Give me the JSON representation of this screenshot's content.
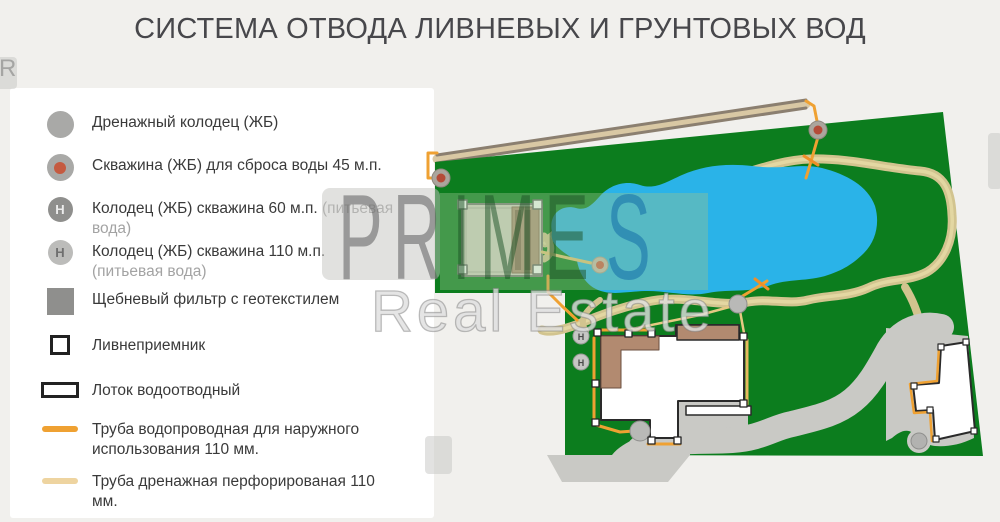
{
  "title": "СИСТЕМА ОТВОДА ЛИВНЕВЫХ И ГРУНТОВЫХ ВОД",
  "watermark": {
    "letters_gray": "PR",
    "letters_green": "IME",
    "letters_blue": "S",
    "line2": "Real Estate",
    "tile_letter": "R"
  },
  "colors": {
    "plot_green": "#0c7d1e",
    "pond_blue": "#2ab3e8",
    "path_tan": "#d2c48f",
    "driveway_gray": "#c9c9c5",
    "roof_brown": "#b28a70",
    "water_pipe_orange": "#efa132",
    "drain_pipe_light": "#eed4a0",
    "well_gray": "#a9a9a7",
    "borehole_red": "#c55a40"
  },
  "legend": {
    "items": [
      {
        "id": "drain-well",
        "icon": "circle",
        "color": "#a9a9a7",
        "label": "Дренажный колодец (ЖБ)",
        "muted": ""
      },
      {
        "id": "discharge-well",
        "icon": "circle-dot",
        "color": "#a9a9a7",
        "dot": "#c55a40",
        "label": "Скважина (ЖБ) для сброса воды 45 м.п.",
        "muted": ""
      },
      {
        "id": "well-60",
        "icon": "circle-letter",
        "color": "#8f8f8d",
        "letter": "Н",
        "letter_color": "#ececec",
        "label": "Колодец (ЖБ) скважина 60 м.п.",
        "muted": "(питьевая вода)"
      },
      {
        "id": "well-110",
        "icon": "circle-letter",
        "color": "#bcbcba",
        "letter": "Н",
        "letter_color": "#6f6f6f",
        "label": "Колодец (ЖБ) скважина 110 м.п.",
        "muted": "(питьевая вода)"
      },
      {
        "id": "gravel-filter",
        "icon": "square",
        "color": "#8f8f8d",
        "label": "Щебневый фильтр с геотекстилем",
        "muted": ""
      },
      {
        "id": "storm-inlet",
        "icon": "square-outline",
        "label": "Ливнеприемник",
        "muted": ""
      },
      {
        "id": "drain-tray",
        "icon": "rect-outline",
        "label": "Лоток водоотводный",
        "muted": ""
      },
      {
        "id": "water-pipe",
        "icon": "line",
        "color": "#efa132",
        "label": "Труба водопроводная для наружного использования 110 мм.",
        "muted": ""
      },
      {
        "id": "drain-pipe",
        "icon": "line",
        "color": "#eed4a0",
        "label": "Труба дренажная перфорированая 110 мм.",
        "muted": ""
      }
    ]
  },
  "map": {
    "shapes": [
      {
        "n": "channel-fill",
        "t": "line",
        "x1": 437,
        "y1": 159,
        "x2": 806,
        "y2": 104,
        "s": "#d9c8a4",
        "w": 9
      },
      {
        "n": "channel-edge-top",
        "t": "line",
        "x1": 437,
        "y1": 155,
        "x2": 806,
        "y2": 100,
        "s": "#8b7f70",
        "w": 3
      },
      {
        "n": "channel-edge-bottom",
        "t": "line",
        "x1": 437,
        "y1": 163,
        "x2": 806,
        "y2": 108,
        "s": "#8b7f70",
        "w": 3
      },
      {
        "n": "pipe-channel-left",
        "t": "pline",
        "pts": [
          [
            437,
            153
          ],
          [
            428,
            153
          ],
          [
            428,
            178
          ],
          [
            441,
            178
          ]
        ],
        "s": "#efa132",
        "w": 3
      },
      {
        "n": "pipe-channel-right",
        "t": "pline",
        "pts": [
          [
            806,
            101
          ],
          [
            814,
            106
          ],
          [
            817,
            121
          ]
        ],
        "s": "#efa132",
        "w": 3
      },
      {
        "n": "plot",
        "t": "poly",
        "pts": [
          [
            435,
            162
          ],
          [
            943,
            112
          ],
          [
            983,
            456
          ],
          [
            565,
            455
          ],
          [
            565,
            293
          ],
          [
            435,
            293
          ]
        ],
        "f": "#0c7d1e"
      },
      {
        "n": "path-loop",
        "t": "path",
        "d": "M545,243 C570,218 620,200 680,190 C730,182 770,160 810,159 C850,158 885,168 920,171 C945,173 951,192 952,215 C954,240 944,262 927,272 C908,282 888,278 868,288 C848,297 828,295 808,300 C788,305 768,298 748,302 C718,307 688,296 658,300 C628,304 598,316 576,325 C562,330 550,333 542,330",
        "s": "#d2c48f",
        "w": 9
      },
      {
        "n": "path-loop-inner",
        "t": "path",
        "d": "M545,243 C570,218 620,200 680,190 C730,182 770,160 810,159 C850,158 885,168 920,171 C945,173 951,192 952,215 C954,240 944,262 927,272 C908,282 888,278 868,288 C848,297 828,295 808,300 C788,305 768,298 748,302 C718,307 688,296 658,300 C628,304 598,316 576,325 C562,330 550,333 542,330",
        "s": "#e3d7a2",
        "w": 3.5
      },
      {
        "n": "path-branch-right",
        "t": "path",
        "d": "M905,287 C913,300 918,312 921,328",
        "s": "#d2c48f",
        "w": 8
      },
      {
        "n": "path-branch-house",
        "t": "path",
        "d": "M600,300 C586,310 578,320 586,331",
        "s": "#d2c48f",
        "w": 6
      },
      {
        "n": "path-hook-garage",
        "t": "path",
        "d": "M544,236 C553,243 553,255 544,259",
        "s": "#d2c48f",
        "w": 7
      },
      {
        "n": "pond",
        "t": "path",
        "d": "M552,232 C548,214 562,204 576,208 C586,211 592,205 600,196 C610,185 625,180 640,185 C655,190 666,182 682,175 C702,166 726,163 752,166 C782,170 802,163 822,168 C846,174 868,186 875,206 C880,223 876,241 864,253 C853,264 843,270 828,275 C808,282 788,278 768,286 C748,293 728,289 708,293 C688,297 668,291 648,291 C628,291 613,296 598,290 C584,284 579,271 577,261 C569,256 559,250 554,243 C552,240 551,236 552,232 Z",
        "f": "#2ab3e8"
      },
      {
        "n": "pipe-well-to-pond",
        "t": "pline",
        "pts": [
          [
            818,
            137
          ],
          [
            812,
            158
          ],
          [
            806,
            178
          ]
        ],
        "s": "#efa132",
        "w": 3
      },
      {
        "n": "pipe-cross-mark",
        "t": "line",
        "x1": 804,
        "y1": 156,
        "x2": 818,
        "y2": 165,
        "s": "#ef8f28",
        "w": 3
      },
      {
        "n": "borehole-well-left",
        "t": "circle",
        "cx": 441,
        "cy": 178,
        "r": 9,
        "f": "#aba59d",
        "s": "#8f887f",
        "sw": 1
      },
      {
        "n": "borehole-well-left-center",
        "t": "circle",
        "cx": 441,
        "cy": 178,
        "r": 4.5,
        "f": "#b44b38"
      },
      {
        "n": "borehole-well-top",
        "t": "circle",
        "cx": 818,
        "cy": 130,
        "r": 9,
        "f": "#aba59d",
        "s": "#8f887f",
        "sw": 1
      },
      {
        "n": "borehole-well-top-center",
        "t": "circle",
        "cx": 818,
        "cy": 130,
        "r": 4.5,
        "f": "#b44b38"
      },
      {
        "n": "garage",
        "t": "rect",
        "x": 462,
        "y": 204,
        "w": 80,
        "h": 72,
        "f": "#d8d2c6",
        "s": "#7c7c78",
        "sw": 2
      },
      {
        "n": "garage-inner-border",
        "t": "rect",
        "x": 466,
        "y": 208,
        "w": 72,
        "h": 64,
        "s": "#b3afa5",
        "sw": 1
      },
      {
        "n": "garage-deck",
        "t": "rect",
        "x": 512,
        "y": 207,
        "w": 27,
        "h": 66,
        "f": "#b18f79",
        "s": "#8a6c58",
        "sw": 1
      },
      {
        "n": "garage-deck-stripe",
        "t": "rect",
        "x": 515,
        "y": 210,
        "w": 6,
        "h": 60,
        "f": "#8a6c58"
      },
      {
        "n": "garage-deck-stripe",
        "t": "rect",
        "x": 525,
        "y": 210,
        "w": 6,
        "h": 60,
        "f": "#8a6c58"
      },
      {
        "n": "garage-corner-inlet",
        "t": "rect",
        "x": 458,
        "y": 200,
        "w": 9,
        "h": 9,
        "f": "#ffffff",
        "s": "#666666",
        "sw": 1.5
      },
      {
        "n": "garage-corner-inlet",
        "t": "rect",
        "x": 533,
        "y": 200,
        "w": 9,
        "h": 9,
        "f": "#ffffff",
        "s": "#666666",
        "sw": 1.5
      },
      {
        "n": "garage-corner-inlet",
        "t": "rect",
        "x": 458,
        "y": 265,
        "w": 9,
        "h": 9,
        "f": "#ffffff",
        "s": "#666666",
        "sw": 1.5
      },
      {
        "n": "garage-corner-inlet",
        "t": "rect",
        "x": 533,
        "y": 265,
        "w": 9,
        "h": 9,
        "f": "#ffffff",
        "s": "#666666",
        "sw": 1.5
      },
      {
        "n": "pipe-garage-to-well",
        "t": "pline",
        "pts": [
          [
            542,
            252
          ],
          [
            568,
            258
          ],
          [
            591,
            263
          ]
        ],
        "s": "#e7c477",
        "w": 3
      },
      {
        "n": "pipe-garage-down",
        "t": "pline",
        "pts": [
          [
            548,
            276
          ],
          [
            548,
            292
          ],
          [
            562,
            306
          ],
          [
            577,
            320
          ]
        ],
        "s": "#efa132",
        "w": 3
      },
      {
        "n": "borehole-well-pond",
        "t": "circle",
        "cx": 600,
        "cy": 265,
        "r": 8,
        "f": "#cbb9ae",
        "s": "#b09e92",
        "sw": 1
      },
      {
        "n": "borehole-well-pond-center",
        "t": "circle",
        "cx": 600,
        "cy": 265,
        "r": 4,
        "f": "#d05a44"
      },
      {
        "n": "driveway-patio",
        "t": "path",
        "d": "M678,401 L748,401 L748,438 L678,438 Z",
        "f": "#c9c9c5"
      },
      {
        "n": "driveway-road",
        "t": "path",
        "d": "M640,449 C680,438 702,442 732,440 C762,438 772,428 792,424 C816,418 836,414 853,400 C869,387 879,368 889,350 C895,340 903,333 913,329 C923,325 933,325 941,327",
        "s": "#c9c9c5",
        "w": 26
      },
      {
        "n": "driveway-right-blob",
        "t": "path",
        "d": "M886,328 L968,336 L974,438 C960,445 946,447 935,446 C925,445 920,438 913,433 C906,428 899,432 892,438 L886,441 Z",
        "f": "#c9c9c5"
      },
      {
        "n": "driveway-entrance",
        "t": "path",
        "d": "M547,455 L612,455 C618,447 628,442 638,437 C652,430 672,428 690,432 L690,455 L668,482 L562,482 Z",
        "f": "#c9c9c5"
      },
      {
        "n": "driveway-bump",
        "t": "circle",
        "cx": 919,
        "cy": 441,
        "r": 12,
        "f": "#c9c9c5"
      },
      {
        "n": "drain-tray",
        "t": "rect",
        "x": 686,
        "y": 406,
        "w": 65,
        "h": 9,
        "f": "#ffffff",
        "s": "#2a2a2a",
        "sw": 1.5
      },
      {
        "n": "main-house",
        "t": "path",
        "d": "M601,336 L676,336 L676,325 L739,325 L739,336 L744,336 L744,401 L678,401 L678,438 L650,438 L650,420 L601,420 Z",
        "f": "#ffffff",
        "s": "#2a2a2a",
        "sw": 2
      },
      {
        "n": "main-house-roof-left",
        "t": "path",
        "d": "M601,336 L659,336 L659,350 L621,350 L621,388 L601,388 Z",
        "f": "#b28a70",
        "s": "#6b4f3f",
        "sw": 1
      },
      {
        "n": "main-house-roof-top",
        "t": "rect",
        "x": 677,
        "y": 325,
        "w": 62,
        "h": 15,
        "f": "#b28a70",
        "s": "#2a2a2a",
        "sw": 1.5
      },
      {
        "n": "pipe-house-top",
        "t": "line",
        "x1": 597,
        "y1": 330,
        "x2": 653,
        "y2": 330,
        "s": "#efa132",
        "w": 3
      },
      {
        "n": "pipe-house-left",
        "t": "line",
        "x1": 594,
        "y1": 338,
        "x2": 594,
        "y2": 423,
        "s": "#efa132",
        "w": 3
      },
      {
        "n": "pipe-house-bottomleft",
        "t": "pline",
        "pts": [
          [
            596,
            425
          ],
          [
            620,
            432
          ],
          [
            634,
            431
          ]
        ],
        "s": "#efa132",
        "w": 3
      },
      {
        "n": "pipe-house-tab",
        "t": "line",
        "x1": 648,
        "y1": 444,
        "x2": 680,
        "y2": 444,
        "s": "#efa132",
        "w": 3
      },
      {
        "n": "pipe-house-right",
        "t": "line",
        "x1": 747,
        "y1": 340,
        "x2": 747,
        "y2": 404,
        "s": "#e7b95e",
        "w": 3
      },
      {
        "n": "pipe-drain-to-well",
        "t": "pline",
        "pts": [
          [
            632,
            329
          ],
          [
            700,
            315
          ],
          [
            733,
            306
          ]
        ],
        "s": "#e5c983",
        "w": 2.5
      },
      {
        "n": "pipe-well-down",
        "t": "pline",
        "pts": [
          [
            740,
            311
          ],
          [
            744,
            333
          ]
        ],
        "s": "#e5c983",
        "w": 2.5
      },
      {
        "n": "pipe-well-up-pond",
        "t": "pline",
        "pts": [
          [
            741,
            297
          ],
          [
            756,
            288
          ],
          [
            767,
            281
          ]
        ],
        "s": "#efa132",
        "w": 3
      },
      {
        "n": "pipe-cross-mark",
        "t": "line",
        "x1": 755,
        "y1": 279,
        "x2": 768,
        "y2": 289,
        "s": "#ef8f28",
        "w": 3
      },
      {
        "n": "drainage-well-junction",
        "t": "circle",
        "cx": 738,
        "cy": 304,
        "r": 9,
        "f": "#b9b9b7",
        "s": "#8f8f8d",
        "sw": 1
      },
      {
        "n": "drainage-well-house",
        "t": "circle",
        "cx": 640,
        "cy": 431,
        "r": 10,
        "f": "#b9b9b7",
        "s": "#8f8f8d",
        "sw": 1
      },
      {
        "n": "guest-house",
        "t": "path",
        "d": "M941,346 L967,342 L975,431 L935,440 L933,410 L916,411 L913,385 L939,383 Z",
        "f": "#ffffff",
        "s": "#2a2a2a",
        "sw": 2
      },
      {
        "n": "pipe-guest-house",
        "t": "pline",
        "pts": [
          [
            939,
            347
          ],
          [
            937,
            381
          ],
          [
            910,
            384
          ],
          [
            914,
            413
          ],
          [
            930,
            412
          ],
          [
            932,
            441
          ]
        ],
        "s": "#efa132",
        "w": 2.5
      },
      {
        "n": "guest-corner-inlet",
        "t": "rect",
        "x": 938,
        "y": 344,
        "w": 6,
        "h": 6,
        "f": "#ffffff",
        "s": "#2a2a2a",
        "sw": 1.2
      },
      {
        "n": "guest-corner-inlet",
        "t": "rect",
        "x": 963,
        "y": 339,
        "w": 6,
        "h": 6,
        "f": "#ffffff",
        "s": "#2a2a2a",
        "sw": 1.2
      },
      {
        "n": "guest-corner-inlet",
        "t": "rect",
        "x": 971,
        "y": 428,
        "w": 6,
        "h": 6,
        "f": "#ffffff",
        "s": "#2a2a2a",
        "sw": 1.2
      },
      {
        "n": "guest-corner-inlet",
        "t": "rect",
        "x": 933,
        "y": 436,
        "w": 6,
        "h": 6,
        "f": "#ffffff",
        "s": "#2a2a2a",
        "sw": 1.2
      },
      {
        "n": "guest-corner-inlet",
        "t": "rect",
        "x": 911,
        "y": 383,
        "w": 6,
        "h": 6,
        "f": "#ffffff",
        "s": "#2a2a2a",
        "sw": 1.2
      },
      {
        "n": "guest-corner-inlet",
        "t": "rect",
        "x": 927,
        "y": 407,
        "w": 6,
        "h": 6,
        "f": "#ffffff",
        "s": "#2a2a2a",
        "sw": 1.2
      },
      {
        "n": "drainage-well-right",
        "t": "circle",
        "cx": 919,
        "cy": 441,
        "r": 8,
        "f": "#b2b2b0",
        "s": "#8f8f8d",
        "sw": 1
      },
      {
        "n": "drinking-well-60",
        "t": "circle",
        "cx": 581,
        "cy": 336,
        "r": 8,
        "f": "#c6c6c4",
        "s": "#9a9a98",
        "sw": 1
      },
      {
        "n": "drinking-well-60-label",
        "t": "text",
        "x": 581,
        "y": 340,
        "str": "Н",
        "size": 9,
        "f": "#4a4a4a"
      },
      {
        "n": "drinking-well-110",
        "t": "circle",
        "cx": 581,
        "cy": 362,
        "r": 8,
        "f": "#c6c6c4",
        "s": "#9a9a98",
        "sw": 1
      },
      {
        "n": "drinking-well-110-label",
        "t": "text",
        "x": 581,
        "y": 366,
        "str": "Н",
        "size": 9,
        "f": "#4a4a4a"
      },
      {
        "n": "house-corner-inlet",
        "t": "rect",
        "x": 594,
        "y": 329,
        "w": 7,
        "h": 7,
        "f": "#ffffff",
        "s": "#222222",
        "sw": 1.3
      },
      {
        "n": "house-corner-inlet",
        "t": "rect",
        "x": 625,
        "y": 330,
        "w": 7,
        "h": 7,
        "f": "#ffffff",
        "s": "#222222",
        "sw": 1.3
      },
      {
        "n": "house-corner-inlet",
        "t": "rect",
        "x": 648,
        "y": 330,
        "w": 7,
        "h": 7,
        "f": "#ffffff",
        "s": "#222222",
        "sw": 1.3
      },
      {
        "n": "house-corner-inlet",
        "t": "rect",
        "x": 740,
        "y": 333,
        "w": 7,
        "h": 7,
        "f": "#ffffff",
        "s": "#222222",
        "sw": 1.3
      },
      {
        "n": "house-corner-inlet",
        "t": "rect",
        "x": 740,
        "y": 400,
        "w": 7,
        "h": 7,
        "f": "#ffffff",
        "s": "#222222",
        "sw": 1.3
      },
      {
        "n": "house-corner-inlet",
        "t": "rect",
        "x": 592,
        "y": 380,
        "w": 7,
        "h": 7,
        "f": "#ffffff",
        "s": "#222222",
        "sw": 1.3
      },
      {
        "n": "house-corner-inlet",
        "t": "rect",
        "x": 592,
        "y": 419,
        "w": 7,
        "h": 7,
        "f": "#ffffff",
        "s": "#222222",
        "sw": 1.3
      },
      {
        "n": "house-corner-inlet",
        "t": "rect",
        "x": 648,
        "y": 437,
        "w": 7,
        "h": 7,
        "f": "#ffffff",
        "s": "#222222",
        "sw": 1.3
      },
      {
        "n": "house-corner-inlet",
        "t": "rect",
        "x": 674,
        "y": 437,
        "w": 7,
        "h": 7,
        "f": "#ffffff",
        "s": "#222222",
        "sw": 1.3
      }
    ]
  }
}
